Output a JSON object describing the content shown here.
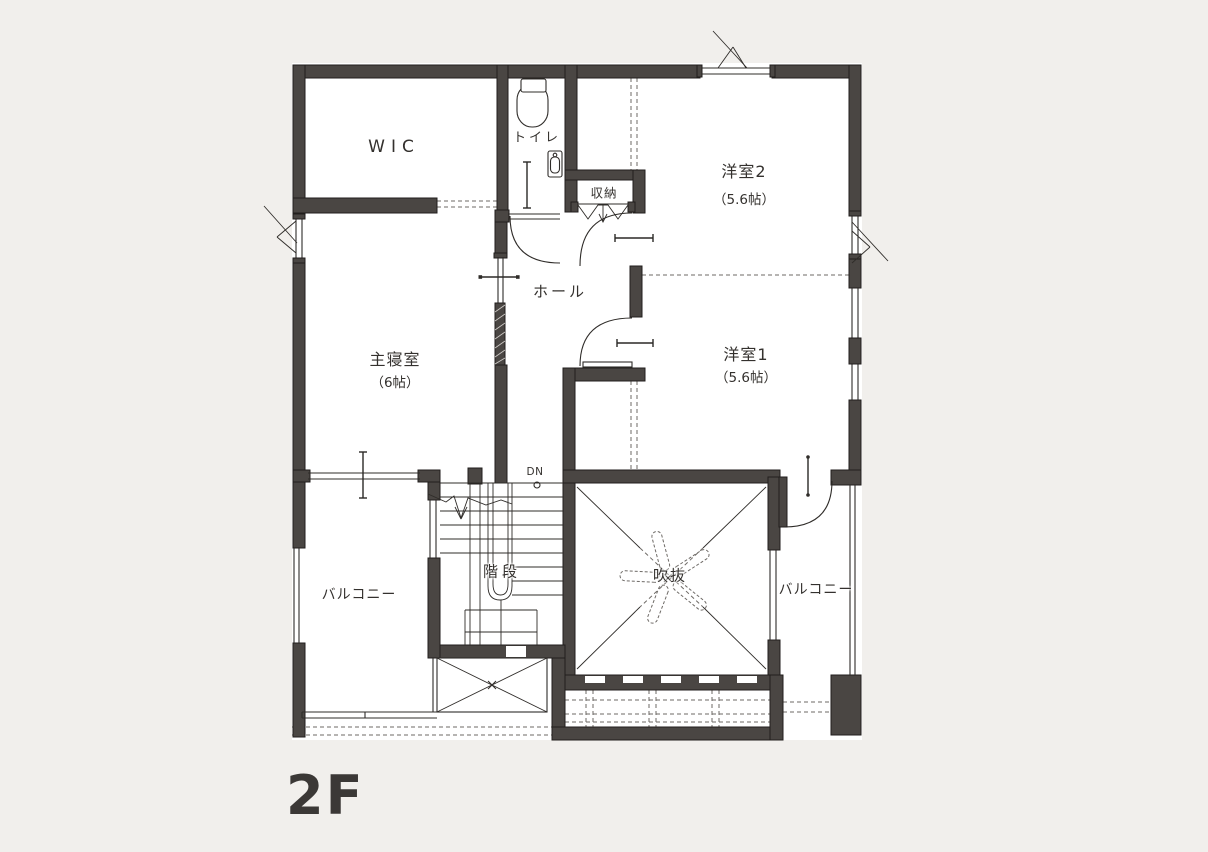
{
  "floor": {
    "label": "2F"
  },
  "rooms": {
    "wic": {
      "label": "WIC"
    },
    "toilet": {
      "label": "トイレ"
    },
    "storage": {
      "label": "収納"
    },
    "western_room_2": {
      "label": "洋室2",
      "size": "（5.6帖）"
    },
    "hall": {
      "label": "ホール"
    },
    "master_bedroom": {
      "label": "主寝室",
      "size": "（6帖）"
    },
    "western_room_1": {
      "label": "洋室1",
      "size": "（5.6帖）"
    },
    "stairs": {
      "label": "階段",
      "direction_label": "DN"
    },
    "void": {
      "label": "吹抜"
    },
    "balcony_left": {
      "label": "バルコニー"
    },
    "balcony_right": {
      "label": "バルコニー"
    }
  },
  "colors": {
    "background": "#f1efec",
    "floor": "#ffffff",
    "wall": "#4a4643",
    "line": "#2f2c29",
    "dashed": "#6e6a66",
    "text": "#34312e"
  }
}
